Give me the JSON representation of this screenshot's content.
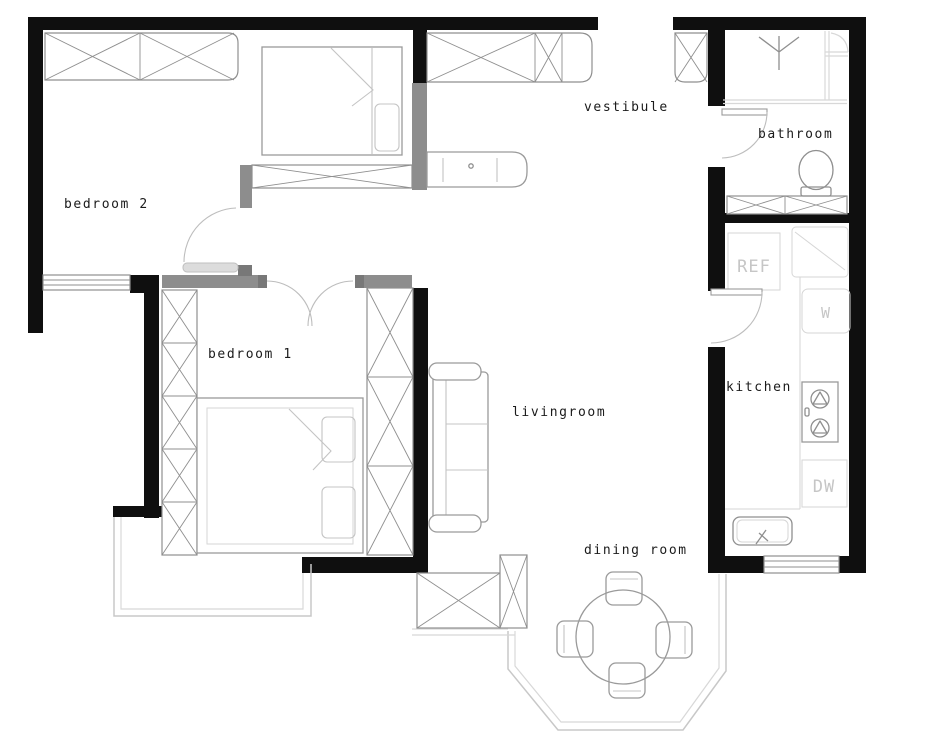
{
  "title": "apartment floor plan",
  "rooms": {
    "bedroom2": "bedroom 2",
    "bedroom1": "bedroom 1",
    "vestibule": "vestibule",
    "bathroom": "bathroom",
    "kitchen": "kitchen",
    "livingroom": "livingroom",
    "dining": "dining room"
  },
  "appliances": {
    "refrigerator": "REF",
    "washer": "W",
    "dishwasher": "DW"
  },
  "colors": {
    "wall": "#0f0f0f",
    "partition": "#8d8d8d",
    "furniture": "#9a9a9a",
    "glass": "#c8c8c8",
    "appliance_text": "#c6c6c6",
    "label_text": "#1b1b1b",
    "background": "#ffffff"
  }
}
